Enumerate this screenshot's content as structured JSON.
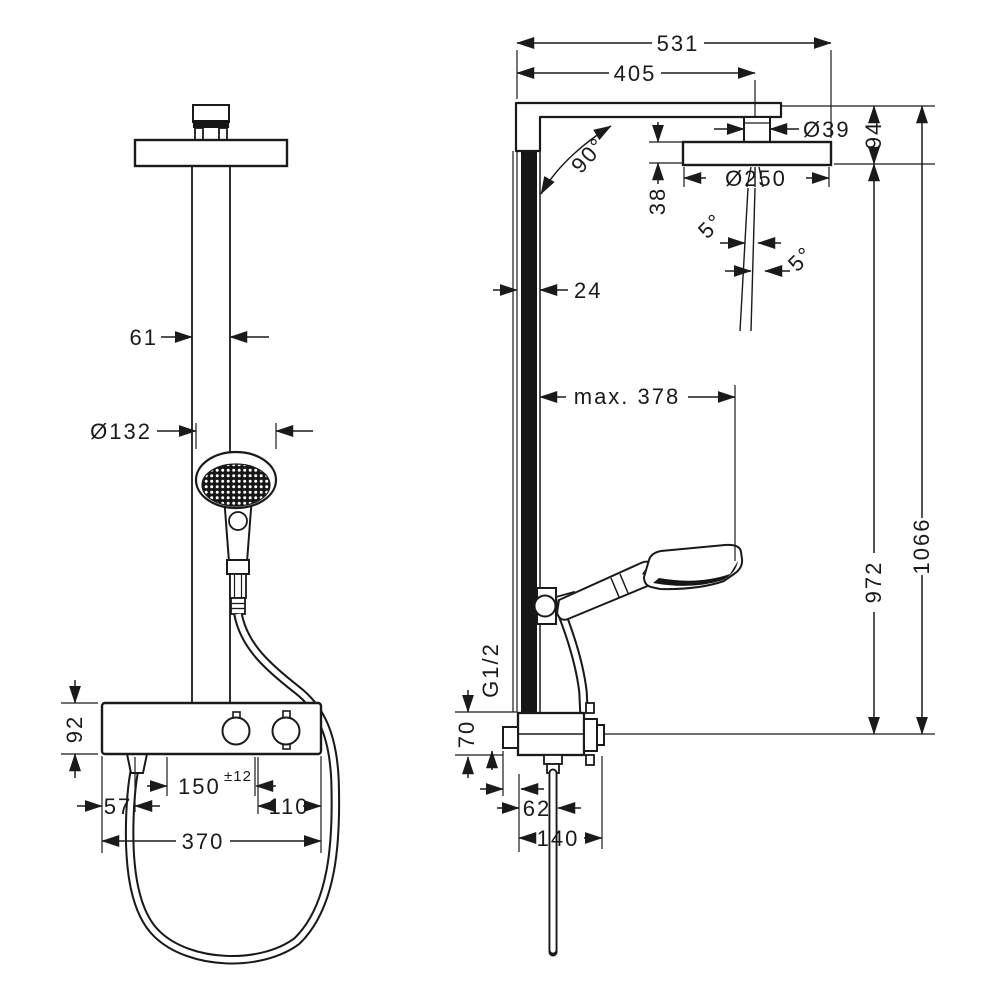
{
  "drawing": {
    "type": "technical-dimension-drawing",
    "subject": "shower-pipe-system-front-and-side-view",
    "colors": {
      "line": "#1a1a1a",
      "background": "#ffffff"
    }
  },
  "dims": {
    "total_width": "531",
    "arm_length": "405",
    "connector_diameter": "Ø39",
    "head_offset": "94",
    "head_diameter": "Ø250",
    "head_thickness": "38",
    "arm_angle": "90°",
    "spray_angle_left": "5°",
    "spray_angle_right": "5°",
    "bar_depth": "24",
    "max_reach": "max. 378",
    "bar_height": "972",
    "total_height": "1066",
    "thread_size": "G1/2",
    "valve_height": "70",
    "hose_offset": "62",
    "valve_depth": "140",
    "pipe_width": "61",
    "hand_shower_diameter": "Ø132",
    "tablet_height": "92",
    "inlet_spacing": "150",
    "inlet_tolerance": "±12",
    "offset_left": "57",
    "offset_right": "110",
    "tablet_width": "370"
  }
}
